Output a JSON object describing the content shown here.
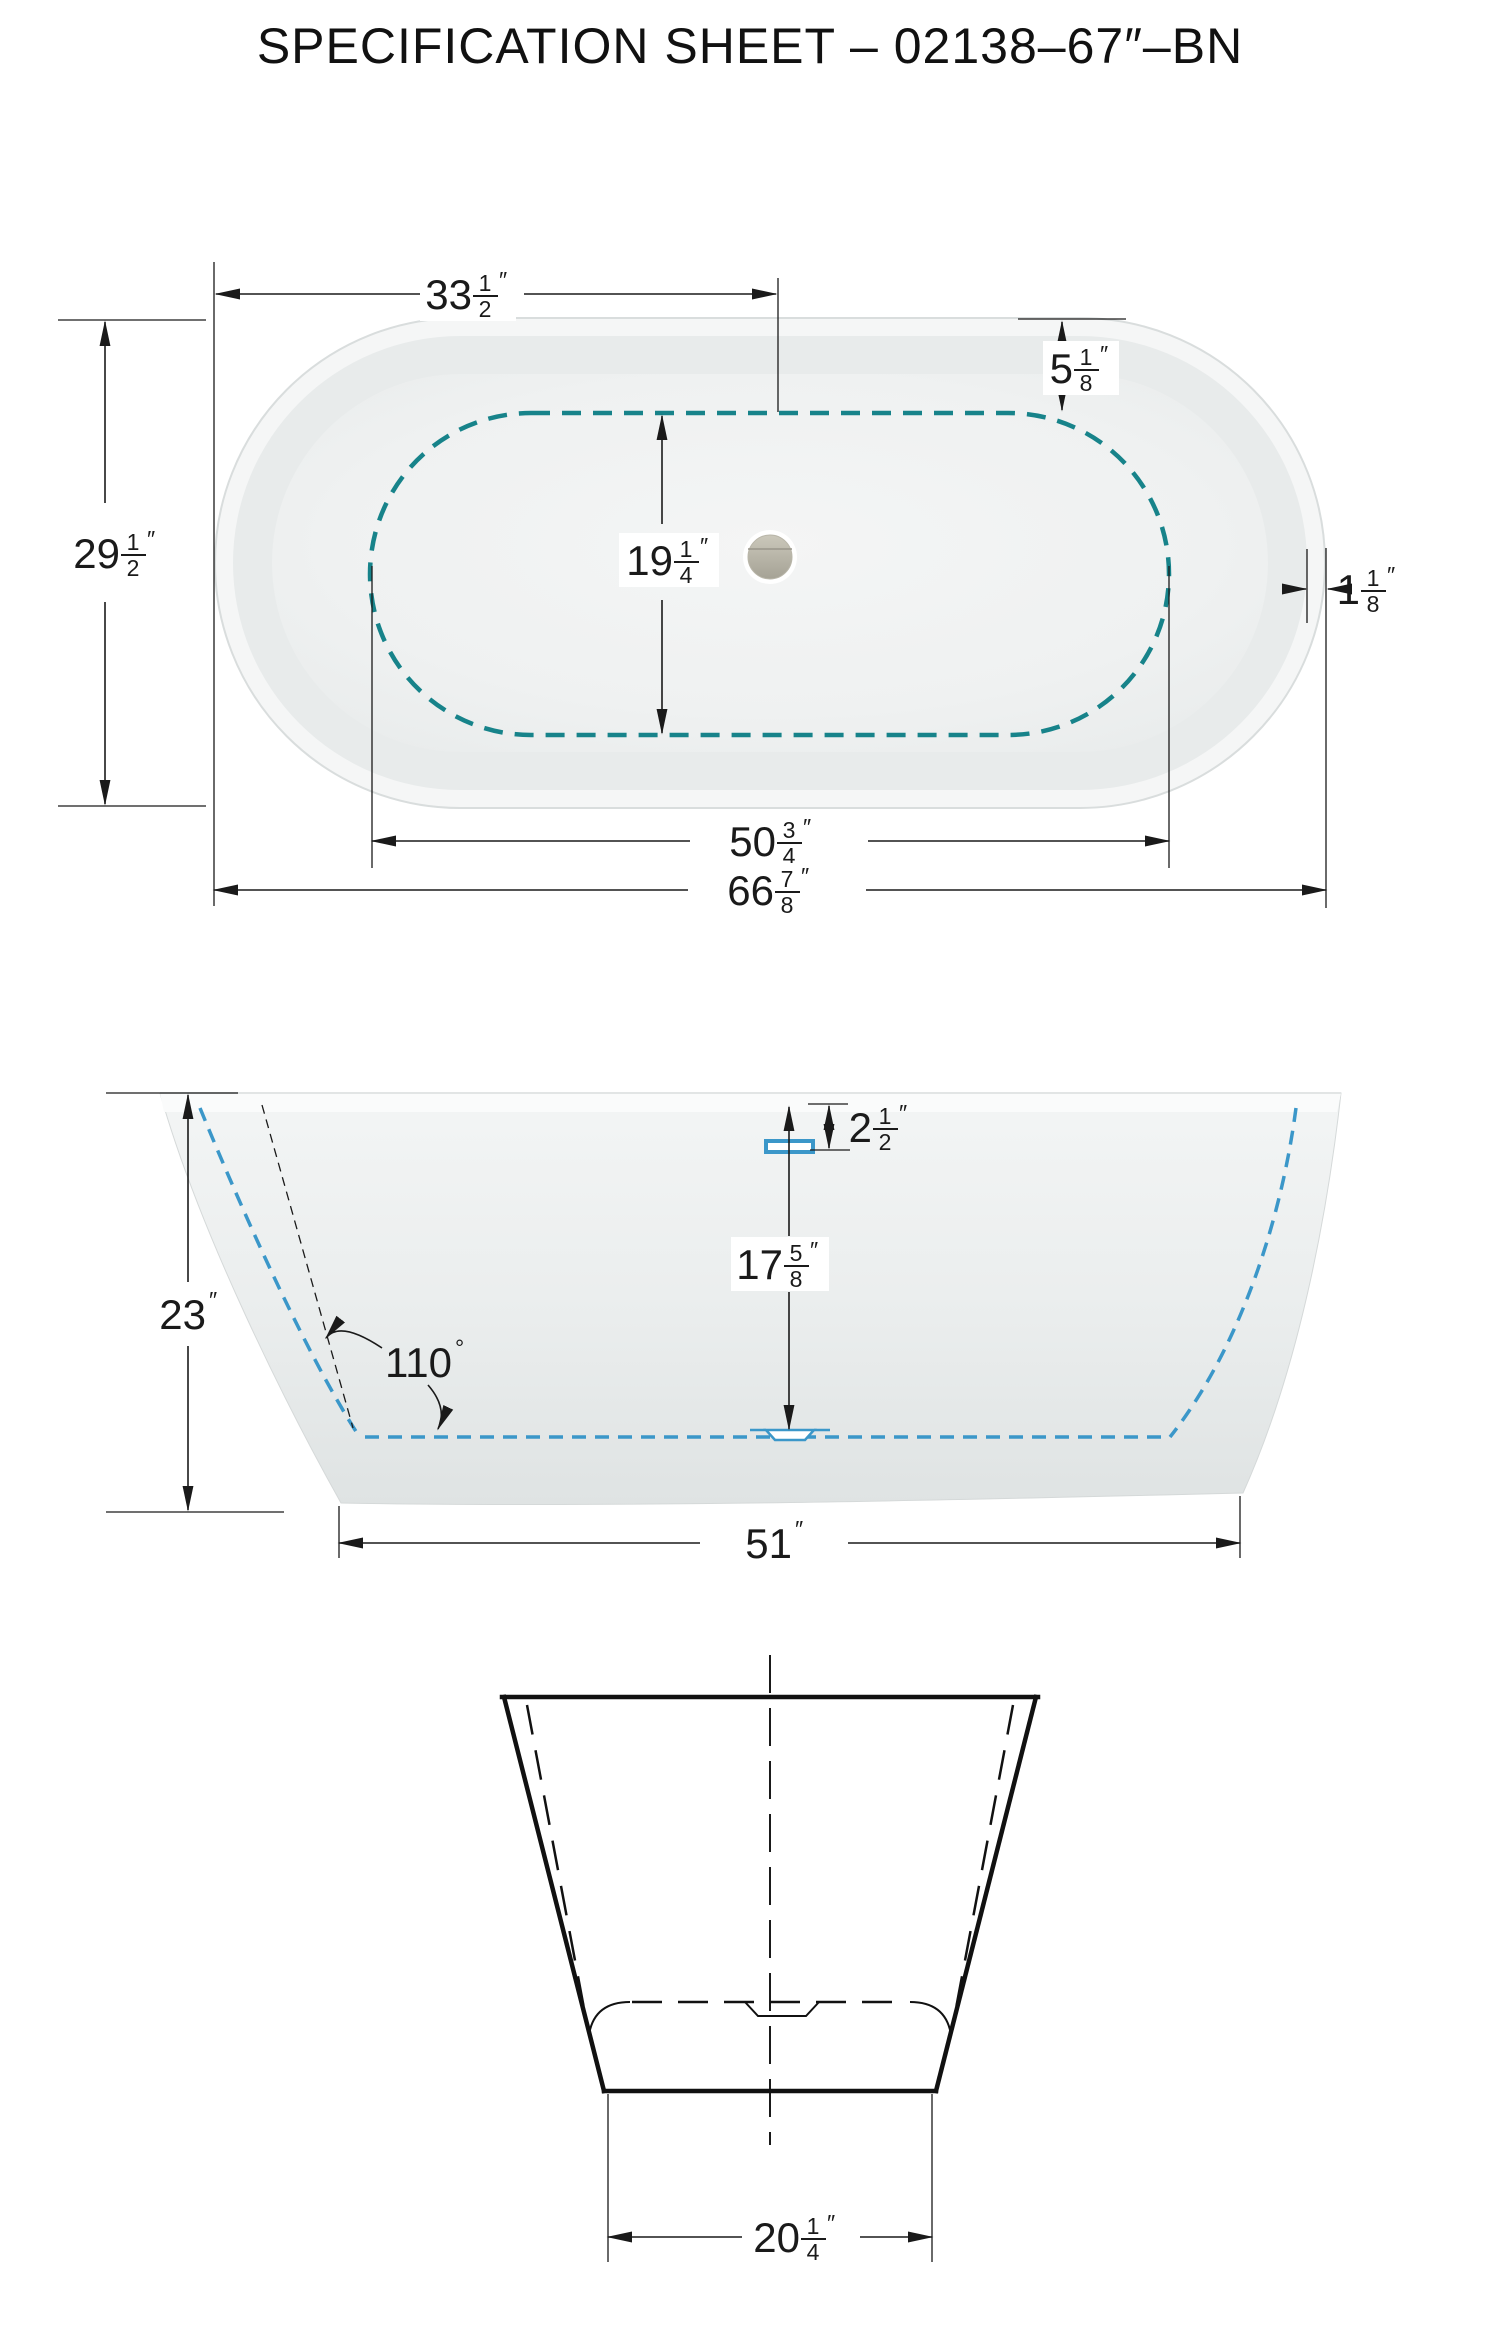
{
  "title": "SPECIFICATION SHEET – 02138–67″–BN",
  "colors": {
    "teal": "#17838A",
    "blue": "#3B97C9",
    "ink": "#1a1a1a"
  },
  "dims": {
    "half_width": {
      "whole": "33",
      "num": "1",
      "den": "2",
      "unit": "″"
    },
    "deck_end": {
      "whole": "5",
      "num": "1",
      "den": "8",
      "unit": "″"
    },
    "overall_width": {
      "whole": "29",
      "num": "1",
      "den": "2",
      "unit": "″"
    },
    "basin_width": {
      "whole": "19",
      "num": "1",
      "den": "4",
      "unit": "″"
    },
    "rim_lip": {
      "whole": "1",
      "num": "1",
      "den": "8",
      "unit": "″"
    },
    "basin_length": {
      "whole": "50",
      "num": "3",
      "den": "4",
      "unit": "″"
    },
    "overall_length": {
      "whole": "66",
      "num": "7",
      "den": "8",
      "unit": "″"
    },
    "overflow_offset": {
      "whole": "2",
      "num": "1",
      "den": "2",
      "unit": "″"
    },
    "overflow_depth": {
      "whole": "17",
      "num": "5",
      "den": "8",
      "unit": "″"
    },
    "height": {
      "whole": "23",
      "unit": "″"
    },
    "wall_angle": {
      "whole": "110",
      "unit": "°"
    },
    "base_length": {
      "whole": "51",
      "unit": "″"
    },
    "base_width": {
      "whole": "20",
      "num": "1",
      "den": "4",
      "unit": "″"
    }
  }
}
